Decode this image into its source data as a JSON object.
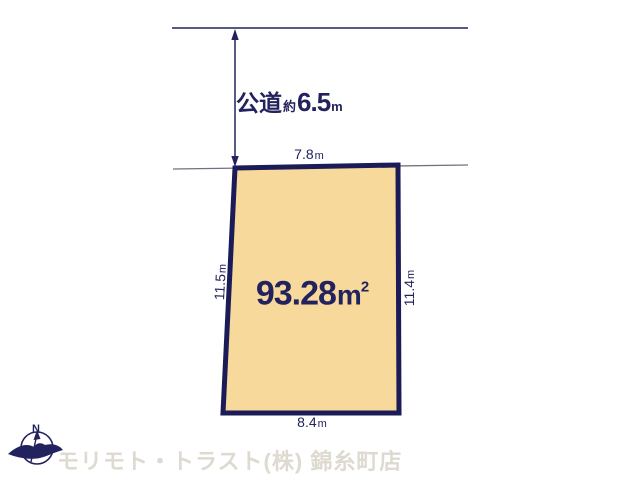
{
  "colors": {
    "navy": "#22225e",
    "plot-fill": "#f6d99b",
    "plot-border": "#1b1b58",
    "dim-line": "#71717f",
    "watermark": "#dedad0"
  },
  "road": {
    "name": "公道",
    "approx": "約",
    "width_value": "6.5",
    "unit": "m"
  },
  "plot": {
    "area_value": "93.28",
    "area_unit": "m",
    "area_sup": "2",
    "edge_top": {
      "value": "7.8",
      "unit": "m"
    },
    "edge_bottom": {
      "value": "8.4",
      "unit": "m"
    },
    "edge_left": {
      "value": "11.5",
      "unit": "m"
    },
    "edge_right": {
      "value": "11.4",
      "unit": "m"
    }
  },
  "compass": {
    "north": "N"
  },
  "footer": {
    "watermark": "モリモト・トラスト(株) 錦糸町店"
  }
}
